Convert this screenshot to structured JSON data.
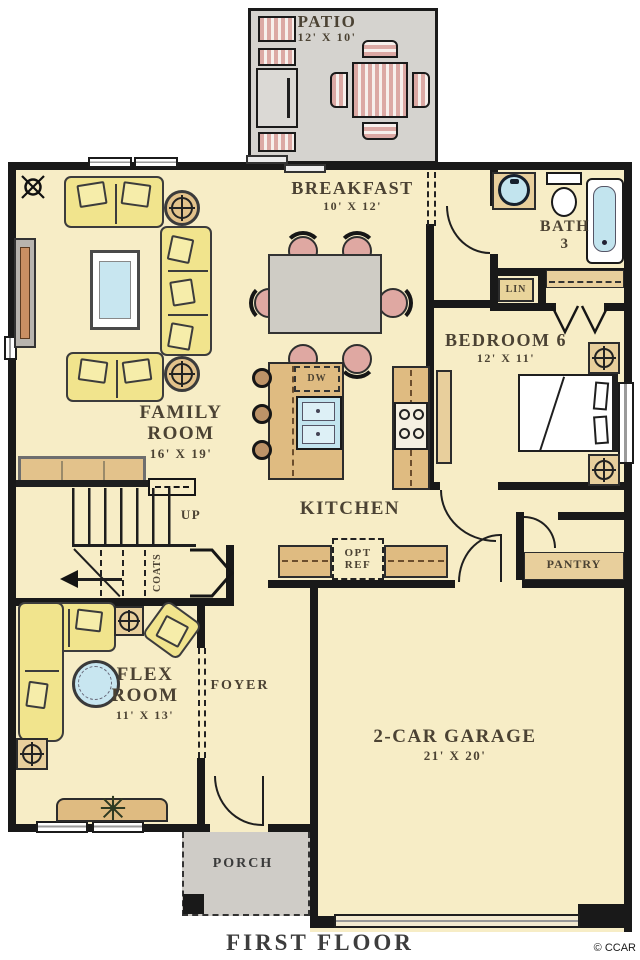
{
  "footer": {
    "title": "FIRST FLOOR",
    "credit": "© CCAR"
  },
  "rooms": {
    "patio": {
      "label": "PATIO",
      "dims": "12' X 10'"
    },
    "breakfast": {
      "label": "BREAKFAST",
      "dims": "10' X 12'"
    },
    "bath": {
      "label": "BATH",
      "number": "3"
    },
    "linen": {
      "label": "LIN"
    },
    "bedroom": {
      "label": "BEDROOM 6",
      "dims": "12' X 11'"
    },
    "family": {
      "line1": "FAMILY",
      "line2": "ROOM",
      "dims": "16' X 19'"
    },
    "kitchen": {
      "label": "KITCHEN"
    },
    "pantry": {
      "label": "PANTRY"
    },
    "coats": {
      "label": "COATS"
    },
    "stairs": {
      "label": "UP"
    },
    "foyer": {
      "label": "FOYER"
    },
    "flex": {
      "line1": "FLEX",
      "line2": "ROOM",
      "dims": "11' X 13'"
    },
    "garage": {
      "label": "2-CAR GARAGE",
      "dims": "21' X 20'"
    },
    "porch": {
      "label": "PORCH"
    }
  },
  "fixtures": {
    "dishwasher": "DW",
    "opt_ref_line1": "OPT",
    "opt_ref_line2": "REF"
  },
  "colors": {
    "floor_cream": "#f7edc6",
    "wall_black": "#191919",
    "patio_gray": "#d5d3cf",
    "porch_gray": "#cfccc7",
    "cabinet_tan": "#dfbb81",
    "furniture_yellow": "#f1e48d",
    "accent_pink": "#dfa8a2",
    "water_blue": "#c2e4ee"
  }
}
